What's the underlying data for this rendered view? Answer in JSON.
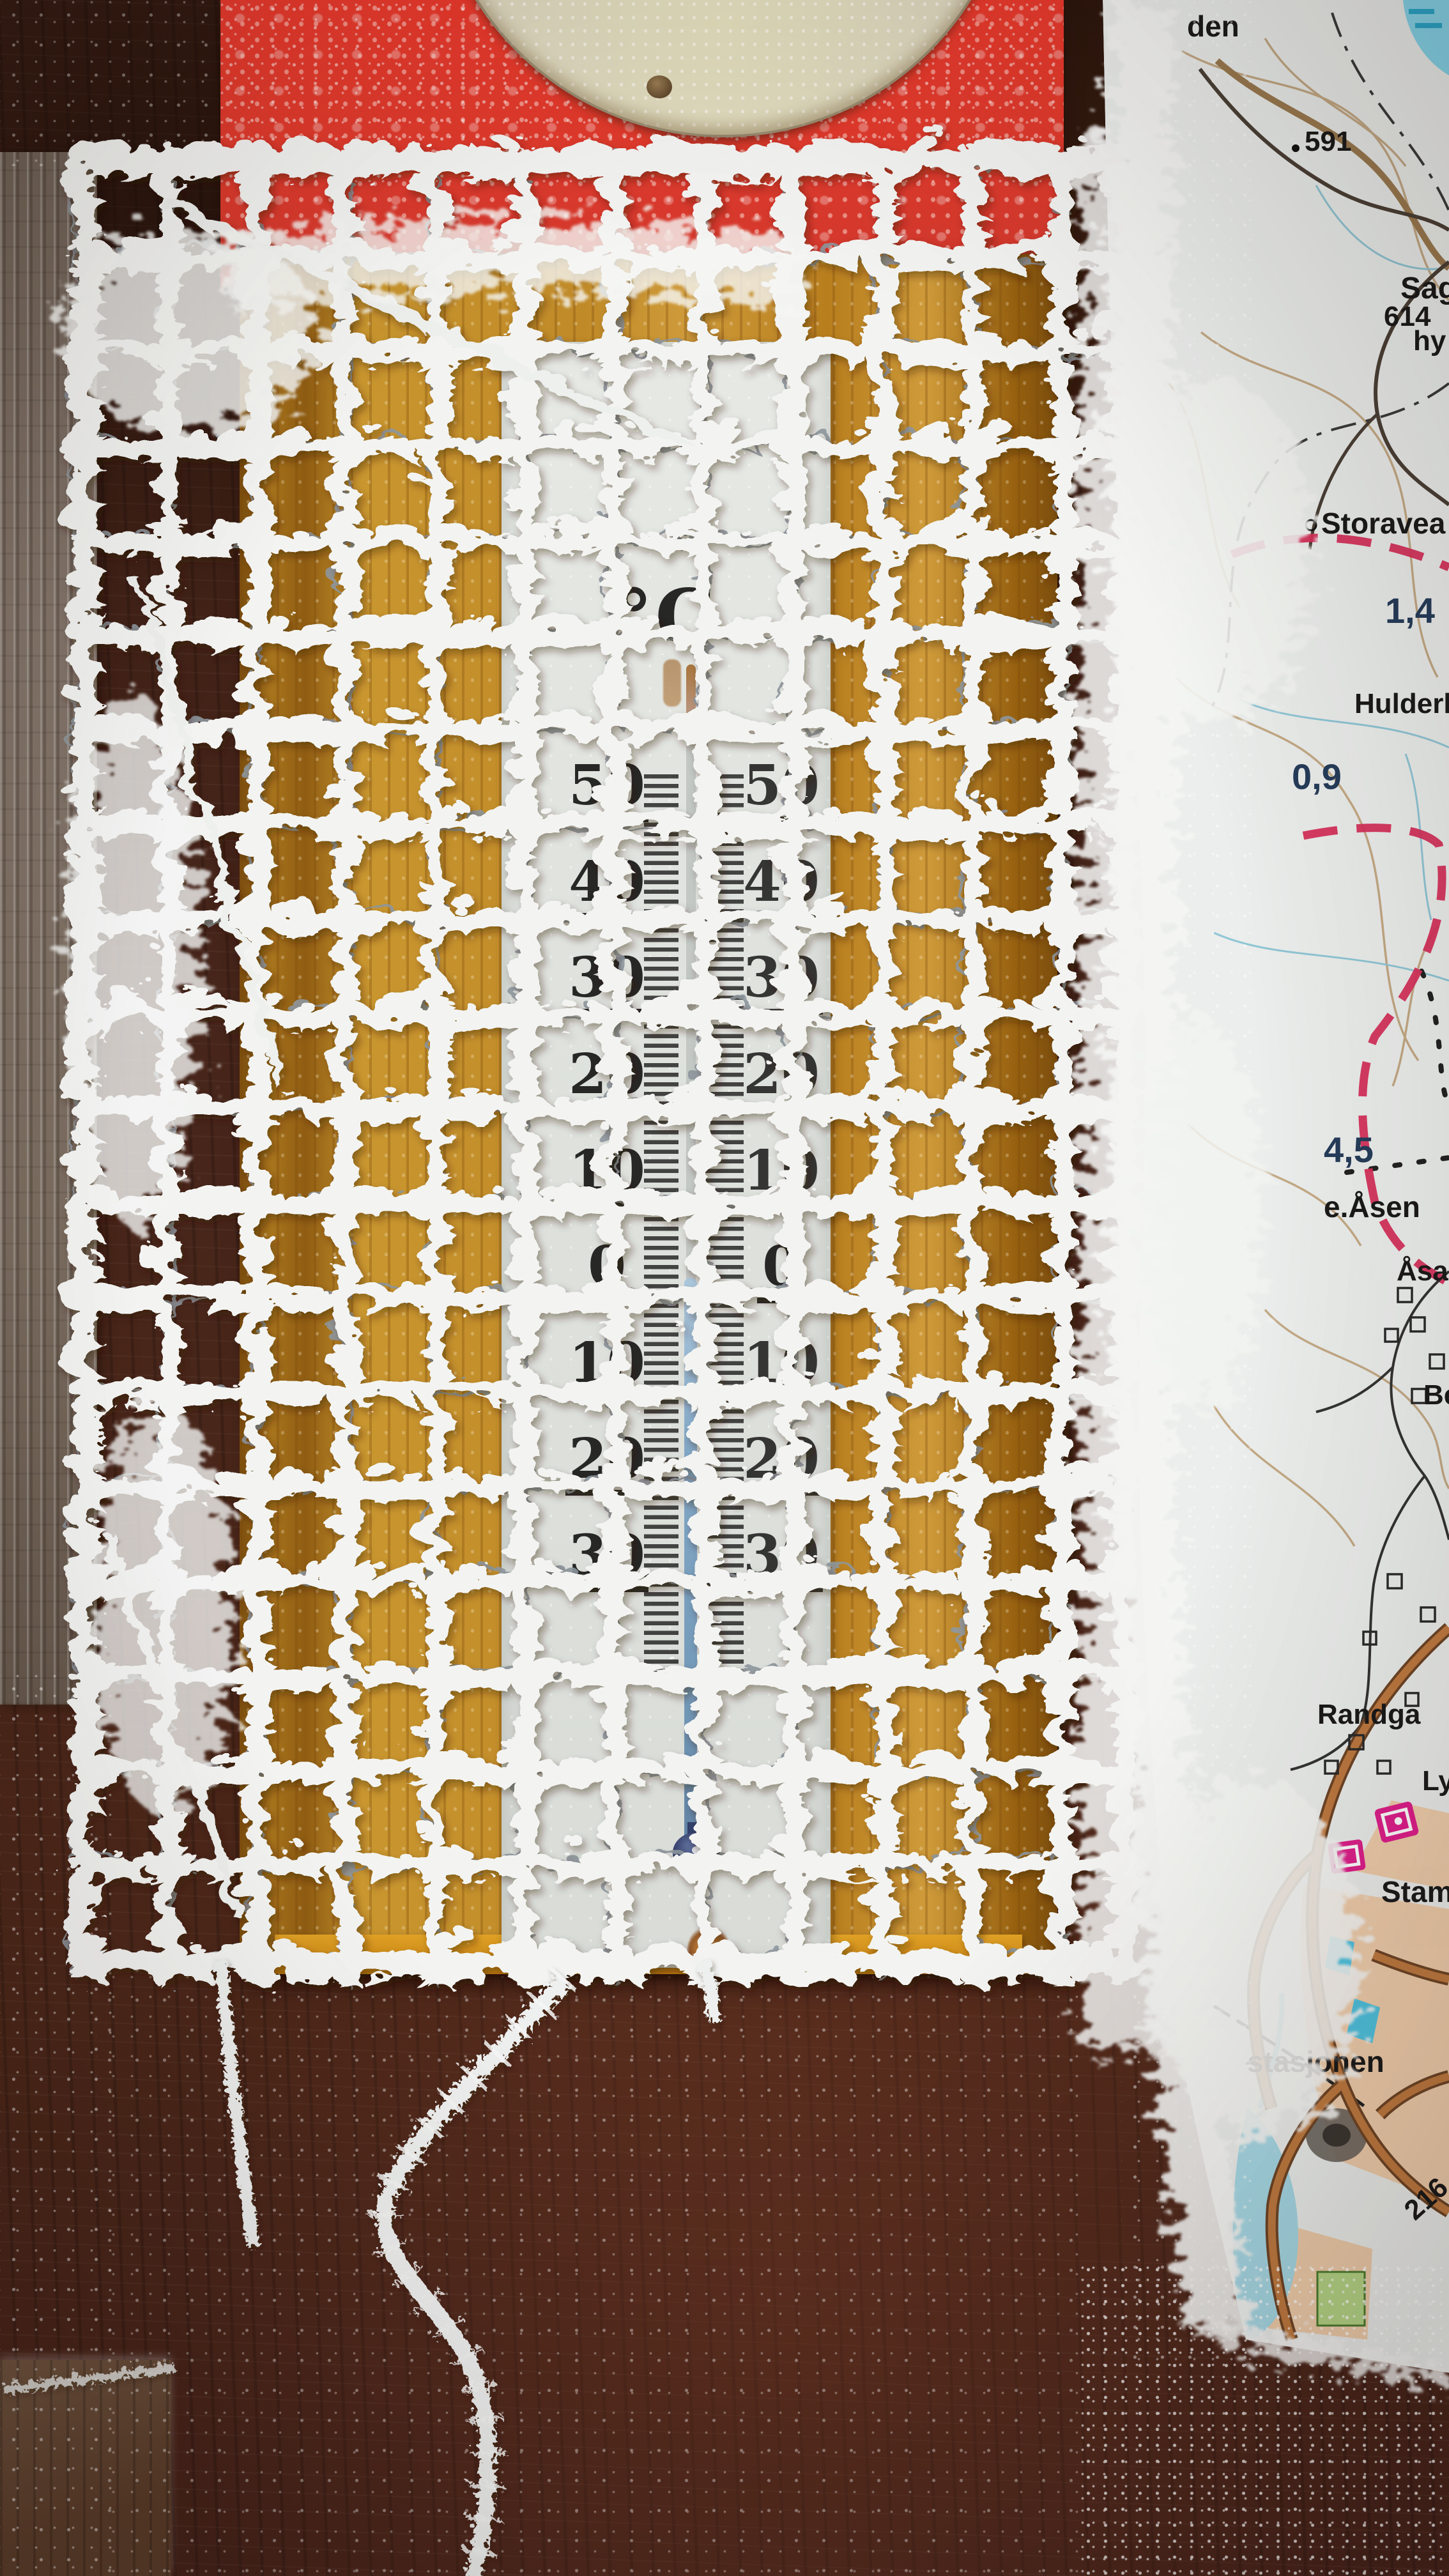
{
  "scene": {
    "description": "Frost-covered outdoor thermometer behind an icy wire mesh on a wooden wall, beside a frosted Norwegian topographic map",
    "colors": {
      "dark_wall": "#44221a",
      "weathered_wood": "#83756a",
      "red_board": "#e8392c",
      "disc": "#d9d4bf",
      "golden_board": "#c08a28",
      "scale_plate": "#e3e5e0",
      "frost_white": "#f3f4f2",
      "liquid_blue": "#7fa6c6",
      "bulb_navy": "#22295a",
      "map_paper": "#ebeeec",
      "map_contour": "#bd9d74",
      "map_trail_red": "#d6305c",
      "map_road_orange": "#bf7a40",
      "map_urban": "#f0cba6",
      "map_water": "#a6d9e6",
      "map_symbol_pink": "#df1f8c"
    }
  },
  "thermometer": {
    "unit": "°C",
    "left_scale": [
      "50",
      "40",
      "30",
      "20",
      "10",
      "0",
      "10",
      "20",
      "30"
    ],
    "right_scale": [
      "50",
      "40",
      "30",
      "20",
      "10",
      "0",
      "10",
      "20",
      "30"
    ]
  },
  "map": {
    "labels": [
      {
        "text": "den"
      },
      {
        "text": "591"
      },
      {
        "text": "Sag"
      },
      {
        "text": "614"
      },
      {
        "text": "hy"
      },
      {
        "text": "Storavea"
      },
      {
        "text": "1,4"
      },
      {
        "text": "Hulderheim"
      },
      {
        "text": "0,9"
      },
      {
        "text": "4,5"
      },
      {
        "text": "e.Åsen"
      },
      {
        "text": "Åsan"
      },
      {
        "text": "Be"
      },
      {
        "text": "Randga"
      },
      {
        "text": "Ly"
      },
      {
        "text": "Stampe"
      },
      {
        "text": "stasjonen"
      },
      {
        "text": "216"
      }
    ]
  }
}
